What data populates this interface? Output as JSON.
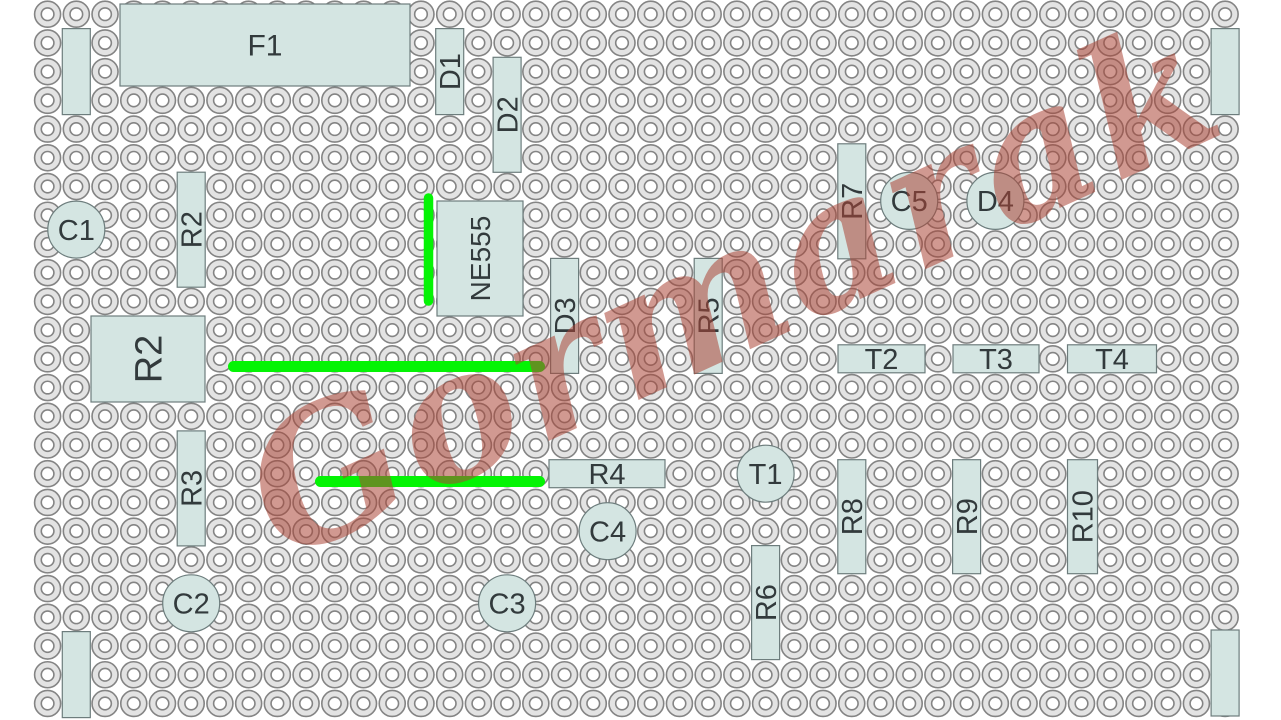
{
  "title": "Stripboard layout diagram",
  "board": {
    "background": "#ffffff",
    "grid": {
      "cols": 42,
      "rows": 25,
      "origin_x": 47.6,
      "origin_y": 14.2,
      "pitch": 28.72,
      "outer_r": 13,
      "inner_r": 6.3,
      "pad_fill": "#e3e3e3",
      "pad_stroke": "#848484",
      "hole_fill": "#ffffff"
    },
    "component_fill": "#d4e5e2",
    "component_stroke": "#6d7d7d",
    "label_color": "#323a3c",
    "wire_color": "#04f404"
  },
  "components": {
    "rects": [
      {
        "id": "F1",
        "label": "F1",
        "x": 120,
        "y": 4,
        "w": 290,
        "h": 82,
        "vertical": false,
        "fs": 30
      },
      {
        "id": "link-top-left",
        "label": "",
        "x": 62.3,
        "y": 28.6,
        "w": 28,
        "h": 86,
        "vertical": true,
        "fs": 29
      },
      {
        "id": "D1",
        "label": "D1",
        "x": 435.7,
        "y": 28.6,
        "w": 28,
        "h": 86,
        "vertical": true,
        "fs": 29
      },
      {
        "id": "D2",
        "label": "D2",
        "x": 493.1,
        "y": 57.3,
        "w": 28,
        "h": 115,
        "vertical": true,
        "fs": 29
      },
      {
        "id": "R2-upper",
        "label": "R2",
        "x": 177.2,
        "y": 172.2,
        "w": 28,
        "h": 115,
        "vertical": true,
        "fs": 29
      },
      {
        "id": "NE555",
        "label": "NE555",
        "x": 437,
        "y": 201,
        "w": 86,
        "h": 115,
        "vertical": true,
        "fs": 28
      },
      {
        "id": "D3",
        "label": "D3",
        "x": 550.6,
        "y": 258.4,
        "w": 28,
        "h": 115,
        "vertical": true,
        "fs": 29
      },
      {
        "id": "R2-large",
        "label": "R2",
        "x": 91,
        "y": 316,
        "w": 114,
        "h": 86,
        "vertical": true,
        "fs": 38
      },
      {
        "id": "R5",
        "label": "R5",
        "x": 694.2,
        "y": 258.4,
        "w": 28,
        "h": 115,
        "vertical": true,
        "fs": 29
      },
      {
        "id": "R7",
        "label": "R7",
        "x": 837.8,
        "y": 143.8,
        "w": 28,
        "h": 115,
        "vertical": true,
        "fs": 29
      },
      {
        "id": "T2",
        "label": "T2",
        "x": 838,
        "y": 344.8,
        "w": 87,
        "h": 28,
        "vertical": false,
        "fs": 29
      },
      {
        "id": "T3",
        "label": "T3",
        "x": 953,
        "y": 344.8,
        "w": 86,
        "h": 28,
        "vertical": false,
        "fs": 29
      },
      {
        "id": "T4",
        "label": "T4",
        "x": 1067.5,
        "y": 344.8,
        "w": 89,
        "h": 28,
        "vertical": false,
        "fs": 29
      },
      {
        "id": "link-top-right",
        "label": "",
        "x": 1211.1,
        "y": 28.6,
        "w": 28,
        "h": 86,
        "vertical": true,
        "fs": 29
      },
      {
        "id": "R3",
        "label": "R3",
        "x": 177.2,
        "y": 430.9,
        "w": 28,
        "h": 115,
        "vertical": true,
        "fs": 29
      },
      {
        "id": "R4",
        "label": "R4",
        "x": 549,
        "y": 459.7,
        "w": 116,
        "h": 28,
        "vertical": false,
        "fs": 29
      },
      {
        "id": "R6",
        "label": "R6",
        "x": 751.6,
        "y": 545.6,
        "w": 28,
        "h": 114,
        "vertical": true,
        "fs": 29
      },
      {
        "id": "R8",
        "label": "R8",
        "x": 837.8,
        "y": 459.7,
        "w": 28,
        "h": 114,
        "vertical": true,
        "fs": 29
      },
      {
        "id": "R9",
        "label": "R9",
        "x": 952.6,
        "y": 459.7,
        "w": 28,
        "h": 114,
        "vertical": true,
        "fs": 29
      },
      {
        "id": "R10",
        "label": "R10",
        "x": 1067.5,
        "y": 459.7,
        "w": 30,
        "h": 114,
        "vertical": true,
        "fs": 29
      },
      {
        "id": "link-bottom-left",
        "label": "",
        "x": 62.3,
        "y": 631.6,
        "w": 28,
        "h": 86,
        "vertical": true,
        "fs": 29
      },
      {
        "id": "link-bottom-right",
        "label": "",
        "x": 1211.1,
        "y": 630,
        "w": 28,
        "h": 86,
        "vertical": true,
        "fs": 29
      }
    ],
    "circles": [
      {
        "id": "C1",
        "label": "C1",
        "cx": 76.3,
        "cy": 229.6,
        "r": 28.5
      },
      {
        "id": "C5",
        "label": "C5",
        "cx": 909.2,
        "cy": 200.9,
        "r": 28.5
      },
      {
        "id": "D4",
        "label": "D4",
        "cx": 995.4,
        "cy": 200.9,
        "r": 28.5
      },
      {
        "id": "T1",
        "label": "T1",
        "cx": 765.6,
        "cy": 473.7,
        "r": 28.5
      },
      {
        "id": "C4",
        "label": "C4",
        "cx": 607.6,
        "cy": 531.2,
        "r": 28.5
      },
      {
        "id": "C3",
        "label": "C3",
        "cx": 507.1,
        "cy": 603.3,
        "r": 28.5
      },
      {
        "id": "C2",
        "label": "C2",
        "cx": 191.2,
        "cy": 603.3,
        "r": 28.5
      }
    ],
    "wires": [
      {
        "id": "wire-vertical",
        "x1": 428.5,
        "y1": 198,
        "x2": 428.5,
        "y2": 301,
        "w": 9.5
      },
      {
        "id": "wire-long-middle",
        "x1": 233.5,
        "y1": 366.5,
        "x2": 539.5,
        "y2": 366.5,
        "w": 11
      },
      {
        "id": "wire-short-lower",
        "x1": 320.5,
        "y1": 481.5,
        "x2": 539.5,
        "y2": 481.5,
        "w": 11
      }
    ]
  },
  "watermark": {
    "text": "Gormarak",
    "color": "rgba(171,70,54,0.55)",
    "angle_deg": -24.5
  }
}
